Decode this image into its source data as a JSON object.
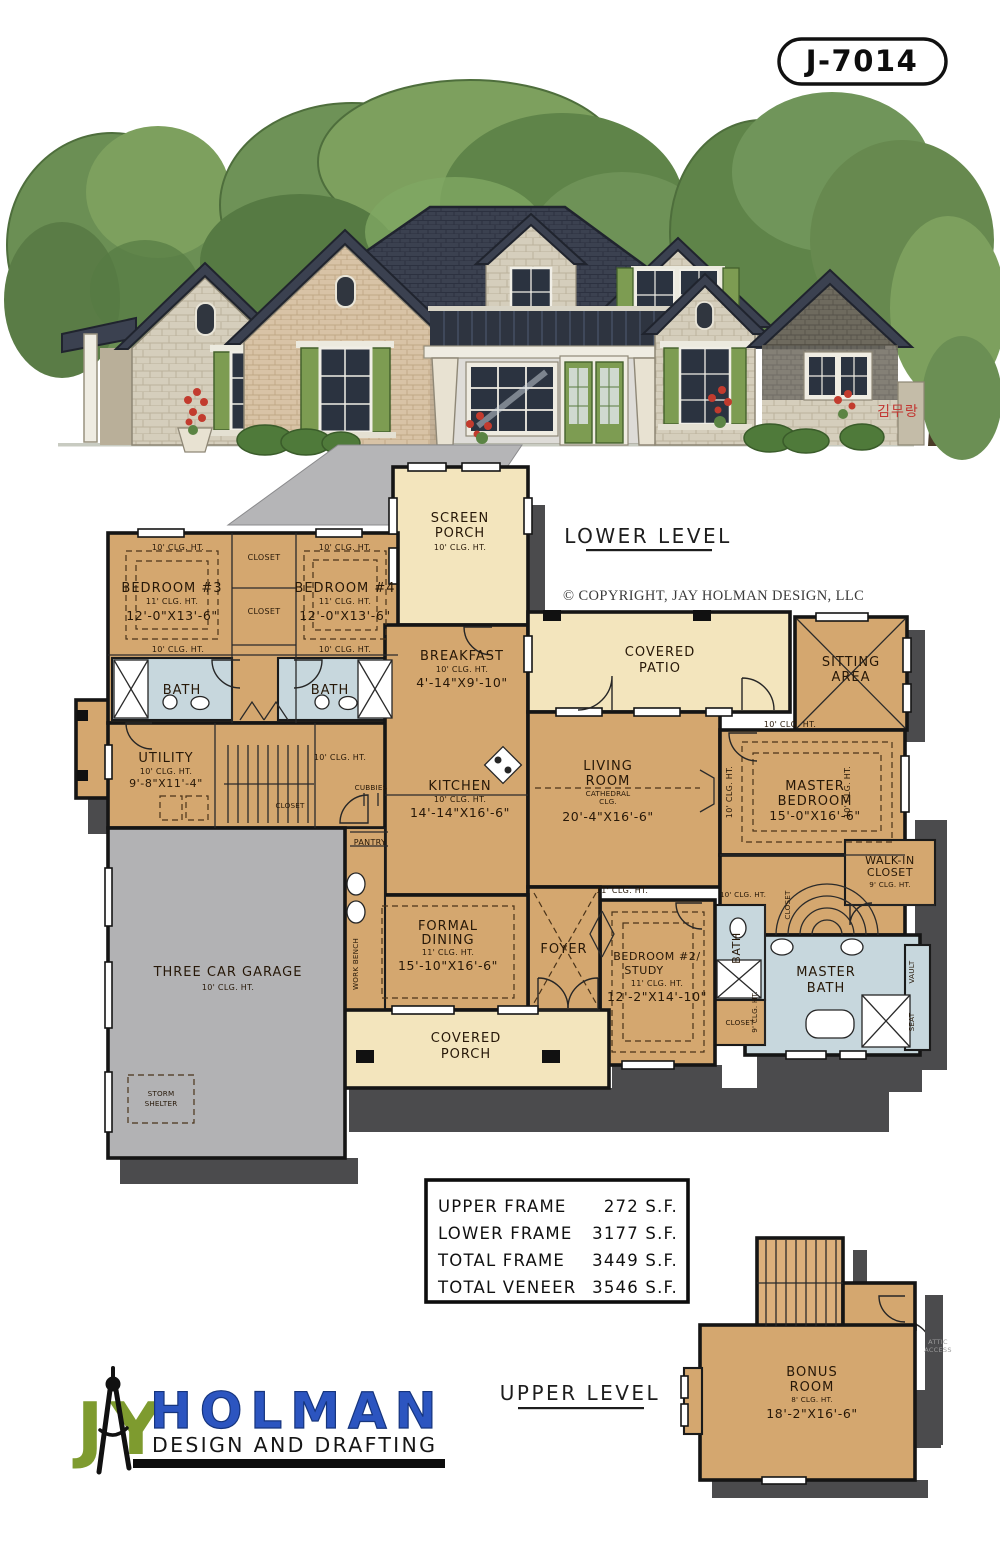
{
  "plan_number": "J-7014",
  "copyright_text": "© COPYRIGHT, JAY HOLMAN DESIGN, LLC",
  "lower_level_label": "LOWER LEVEL",
  "upper_level_label": "UPPER LEVEL",
  "signature": "김무랑",
  "annotations": {
    "clg10": "10' CLG. HT.",
    "clg11": "11' CLG. HT.",
    "clg9": "9' CLG. HT."
  },
  "rooms": {
    "screen_porch": {
      "lines": [
        "SCREEN",
        "PORCH",
        "10' CLG. HT."
      ]
    },
    "bedroom3": {
      "lines": [
        "BEDROOM #3",
        "11' CLG. HT.",
        "12'-0\"X13'-6\""
      ]
    },
    "bedroom4": {
      "lines": [
        "BEDROOM #4",
        "11' CLG. HT.",
        "12'-0\"X13'-6\""
      ]
    },
    "breakfast": {
      "lines": [
        "BREAKFAST",
        "10' CLG. HT.",
        "4'-14\"X9'-10\""
      ]
    },
    "covered_patio": {
      "lines": [
        "COVERED",
        "PATIO"
      ]
    },
    "sitting_area": {
      "lines": [
        "SITTING",
        "AREA"
      ]
    },
    "utility": {
      "lines": [
        "UTILITY",
        "10' CLG. HT.",
        "9'-8\"X11'-4\""
      ]
    },
    "kitchen": {
      "lines": [
        "KITCHEN",
        "10' CLG. HT.",
        "14'-14\"X16'-6\""
      ]
    },
    "living_room": {
      "lines": [
        "LIVING",
        "ROOM",
        "CATHEDRAL",
        "CLG.",
        "20'-4\"X16'-6\""
      ]
    },
    "master_bedroom": {
      "lines": [
        "MASTER",
        "BEDROOM",
        "15'-0\"X16'-6\""
      ]
    },
    "walk_in_closet": {
      "lines": [
        "WALK-IN",
        "CLOSET",
        "9' CLG. HT."
      ]
    },
    "master_bath": {
      "lines": [
        "MASTER",
        "BATH"
      ]
    },
    "bedroom2": {
      "lines": [
        "BEDROOM #2/",
        "STUDY",
        "11' CLG. HT.",
        "12'-2\"X14'-10\""
      ]
    },
    "formal_dining": {
      "lines": [
        "FORMAL",
        "DINING",
        "11' CLG. HT.",
        "15'-10\"X16'-6\""
      ]
    },
    "covered_porch": {
      "lines": [
        "COVERED",
        "PORCH"
      ]
    },
    "garage": {
      "lines": [
        "THREE CAR GARAGE",
        "10' CLG. HT."
      ]
    },
    "storm_shelter": {
      "lines": [
        "STORM",
        "SHELTER"
      ]
    },
    "bonus_room": {
      "lines": [
        "BONUS",
        "ROOM",
        "8' CLG. HT.",
        "18'-2\"X16'-6\""
      ]
    },
    "attic_access": {
      "lines": [
        "ATTIC",
        "ACCESS"
      ]
    },
    "foyer": "FOYER",
    "bath": "BATH",
    "closet": "CLOSET",
    "pantry": "PANTRY",
    "cubbies": "CUBBIES",
    "work_bench": "WORK BENCH",
    "vault": "VAULT",
    "seat": "SEAT"
  },
  "sqft_table": {
    "rows": [
      {
        "label": "UPPER FRAME",
        "value": "272 S.F."
      },
      {
        "label": "LOWER FRAME",
        "value": "3177 S.F."
      },
      {
        "label": "TOTAL FRAME",
        "value": "3449 S.F."
      },
      {
        "label": "TOTAL VENEER",
        "value": "3546 S.F."
      }
    ]
  },
  "logo": {
    "j": "J",
    "y": "Y",
    "holman": "HOLMAN",
    "tagline": "DESIGN AND DRAFTING"
  },
  "colors": {
    "room_tan": "#d4a76f",
    "porch_cream": "#f3e5bd",
    "bath_blue": "#c7d7dd",
    "garage_gray": "#b2b2b4",
    "shadow": "#4b4b4d",
    "roof": "#3b4150",
    "shutter_green": "#7d9c52",
    "logo_green": "#7e9b2f",
    "logo_blue": "#2c55c0"
  }
}
